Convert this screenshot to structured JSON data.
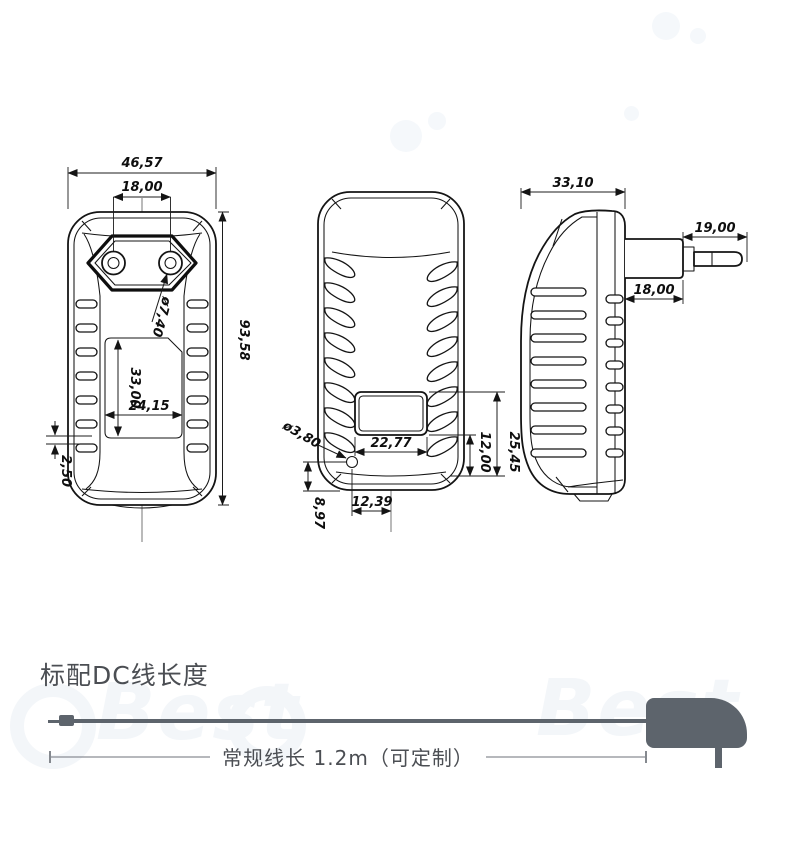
{
  "drawing": {
    "front_view": {
      "total_width": "46,57",
      "pin_spacing": "18,00",
      "total_height": "93,58",
      "pin_diameter": "ø7,40",
      "label_height": "33,00",
      "label_width": "24,15",
      "bottom_offset": "2,50"
    },
    "back_view": {
      "window_width": "22,77",
      "hole_diameter": "ø3,80",
      "window_top_to_bottom": "25,45",
      "window_bottom_to_bottom": "12,00",
      "hole_offset_x": "12,39",
      "hole_offset_y": "8,97"
    },
    "side_view": {
      "body_depth": "33,10",
      "pin_length": "19,00",
      "plug_base_length": "18,00"
    }
  },
  "cable_section": {
    "heading": "标配DC线长度",
    "length_note": "常规线长 1.2m（可定制）"
  },
  "watermark": {
    "text": "Best"
  },
  "colors": {
    "line": "#141414",
    "cable_gray": "#5d646c",
    "text_gray": "#4b4e53",
    "dim_line_gray": "#85898f"
  }
}
